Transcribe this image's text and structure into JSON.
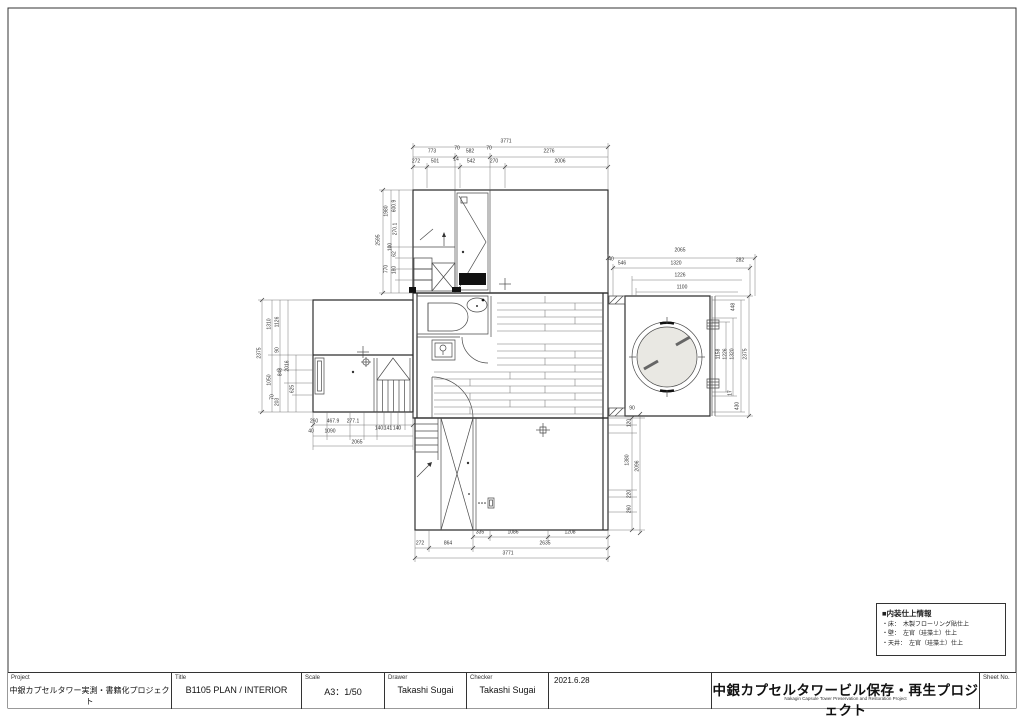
{
  "title_block": {
    "project_label": "Project",
    "project_value": "中銀カプセルタワー実測・書籍化プロジェクト",
    "title_label": "Title",
    "title_value": "B1105 PLAN / INTERIOR",
    "scale_label": "Scale",
    "scale_value": "A3：1/50",
    "drawer_label": "Drawer",
    "drawer_value": "Takashi Sugai",
    "checker_label": "Checker",
    "checker_value": "Takashi Sugai",
    "date_value": "2021.6.28",
    "org_title": "中銀カプセルタワービル保存・再生プロジェクト",
    "org_subtitle": "Nakagin Capsule Tower Preservation and Restoration Project",
    "sheet_label": "Sheet No."
  },
  "legend": {
    "title": "■内装仕上情報",
    "items": [
      "・床：　木製フローリング貼仕上",
      "・壁：　左官（珪藻土）仕上",
      "・天井：　左官（珪藻土）仕上"
    ]
  },
  "drawing": {
    "dim_labels": [
      {
        "t": "3771",
        "x": 506,
        "y": 142
      },
      {
        "t": "773",
        "x": 432,
        "y": 152
      },
      {
        "t": "70",
        "x": 457,
        "y": 149
      },
      {
        "t": "582",
        "x": 470,
        "y": 152
      },
      {
        "t": "70",
        "x": 489,
        "y": 149
      },
      {
        "t": "2276",
        "x": 549,
        "y": 152
      },
      {
        "t": "272",
        "x": 416,
        "y": 162
      },
      {
        "t": "501",
        "x": 435,
        "y": 162
      },
      {
        "t": "14",
        "x": 456,
        "y": 160
      },
      {
        "t": "542",
        "x": 471,
        "y": 162
      },
      {
        "t": "270",
        "x": 494,
        "y": 162
      },
      {
        "t": "2006",
        "x": 560,
        "y": 162
      },
      {
        "t": "335",
        "x": 480,
        "y": 533
      },
      {
        "t": "1086",
        "x": 513,
        "y": 533
      },
      {
        "t": "1208",
        "x": 570,
        "y": 533
      },
      {
        "t": "272",
        "x": 420,
        "y": 544
      },
      {
        "t": "864",
        "x": 448,
        "y": 544
      },
      {
        "t": "2635",
        "x": 545,
        "y": 544
      },
      {
        "t": "3771",
        "x": 508,
        "y": 554
      },
      {
        "t": "2065",
        "x": 680,
        "y": 251
      },
      {
        "t": "40",
        "x": 611,
        "y": 260
      },
      {
        "t": "546",
        "x": 622,
        "y": 264
      },
      {
        "t": "1320",
        "x": 676,
        "y": 264
      },
      {
        "t": "282",
        "x": 740,
        "y": 261
      },
      {
        "t": "1226",
        "x": 680,
        "y": 276
      },
      {
        "t": "1100",
        "x": 682,
        "y": 288
      },
      {
        "t": "448",
        "x": 734,
        "y": 307,
        "r": 1
      },
      {
        "t": "1158",
        "x": 719,
        "y": 354,
        "r": 1
      },
      {
        "t": "1226",
        "x": 726,
        "y": 354,
        "r": 1
      },
      {
        "t": "1320",
        "x": 733,
        "y": 354,
        "r": 1
      },
      {
        "t": "2375",
        "x": 746,
        "y": 354,
        "r": 1
      },
      {
        "t": "17",
        "x": 731,
        "y": 393,
        "r": 1
      },
      {
        "t": "430",
        "x": 738,
        "y": 406,
        "r": 1
      },
      {
        "t": "2375",
        "x": 260,
        "y": 353,
        "r": 1
      },
      {
        "t": "1310",
        "x": 270,
        "y": 324,
        "r": 1
      },
      {
        "t": "1126",
        "x": 278,
        "y": 322,
        "r": 1
      },
      {
        "t": "90",
        "x": 278,
        "y": 350,
        "r": 1
      },
      {
        "t": "848",
        "x": 281,
        "y": 372,
        "r": 1
      },
      {
        "t": "2016",
        "x": 288,
        "y": 366,
        "r": 1
      },
      {
        "t": "625",
        "x": 293,
        "y": 389,
        "r": 1
      },
      {
        "t": "1050",
        "x": 270,
        "y": 380,
        "r": 1
      },
      {
        "t": "70",
        "x": 273,
        "y": 397,
        "r": 1
      },
      {
        "t": "203",
        "x": 278,
        "y": 402,
        "r": 1
      },
      {
        "t": "2595",
        "x": 379,
        "y": 240,
        "r": 1
      },
      {
        "t": "1980",
        "x": 387,
        "y": 211,
        "r": 1
      },
      {
        "t": "600.9",
        "x": 395,
        "y": 206,
        "r": 1
      },
      {
        "t": "270.1",
        "x": 396,
        "y": 229,
        "r": 1
      },
      {
        "t": "100",
        "x": 391,
        "y": 247,
        "r": 1
      },
      {
        "t": "62",
        "x": 395,
        "y": 254,
        "r": 1
      },
      {
        "t": "770",
        "x": 387,
        "y": 269,
        "r": 1
      },
      {
        "t": "180",
        "x": 395,
        "y": 270,
        "r": 1
      },
      {
        "t": "260",
        "x": 314,
        "y": 422
      },
      {
        "t": "467.9",
        "x": 333,
        "y": 422
      },
      {
        "t": "277.1",
        "x": 353,
        "y": 422
      },
      {
        "t": "40",
        "x": 311,
        "y": 432
      },
      {
        "t": "1090",
        "x": 330,
        "y": 432
      },
      {
        "t": "140",
        "x": 379,
        "y": 429
      },
      {
        "t": "141",
        "x": 388,
        "y": 429
      },
      {
        "t": "140",
        "x": 397,
        "y": 429
      },
      {
        "t": "2065",
        "x": 357,
        "y": 443
      },
      {
        "t": "90",
        "x": 632,
        "y": 409
      },
      {
        "t": "120",
        "x": 630,
        "y": 423,
        "r": 1
      },
      {
        "t": "1380",
        "x": 628,
        "y": 460,
        "r": 1
      },
      {
        "t": "2096",
        "x": 638,
        "y": 466,
        "r": 1
      },
      {
        "t": "220",
        "x": 630,
        "y": 494,
        "r": 1
      },
      {
        "t": "260",
        "x": 630,
        "y": 509,
        "r": 1
      }
    ]
  }
}
